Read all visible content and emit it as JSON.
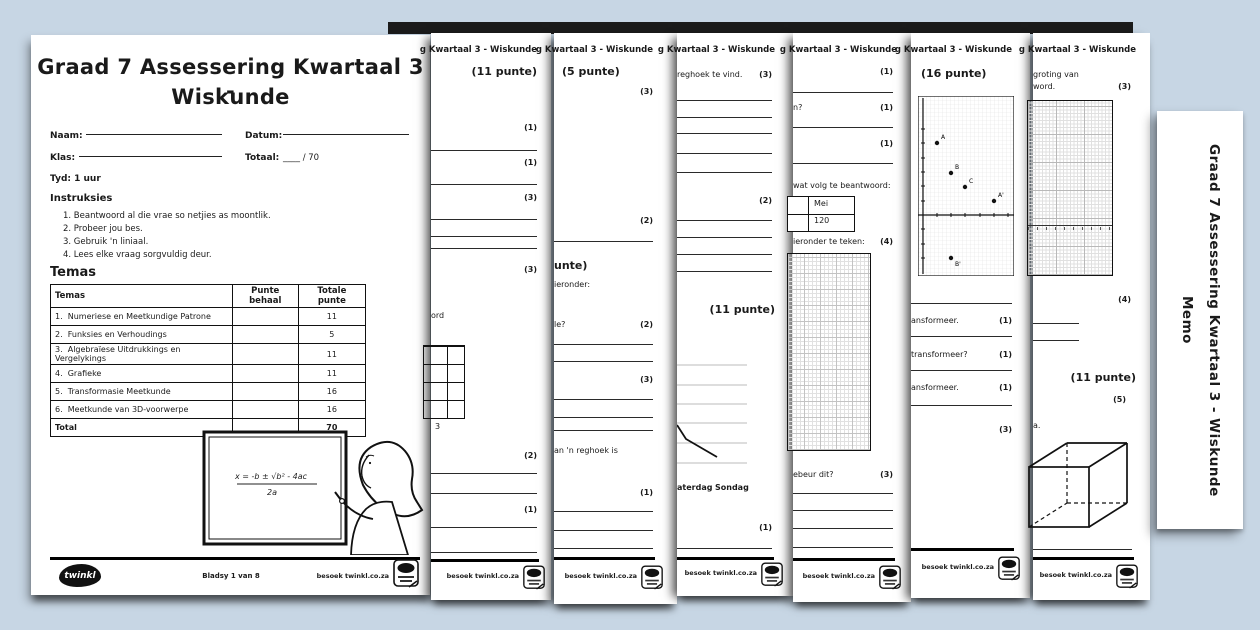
{
  "shared": {
    "strip_header": "g Kwartaal 3 - Wiskunde",
    "visit": "besoek twinkl.co.za",
    "accent_bg": "#c7d6e4",
    "page_color": "#ffffff",
    "ink_color": "#1a1a1a"
  },
  "page1": {
    "title_line1": "Graad 7 Assessering Kwartaal 3 -",
    "title_line2": "Wiskunde",
    "naam_label": "Naam:",
    "datum_label": "Datum:",
    "klas_label": "Klas:",
    "totaal_label": "Totaal:",
    "totaal_value": "____ / 70",
    "tyd": "Tyd: 1 uur",
    "instruksies_heading": "Instruksies",
    "instruksies": [
      "1.  Beantwoord al die vrae so netjies as moontlik.",
      "2.  Probeer jou bes.",
      "3.  Gebruik 'n liniaal.",
      "4.  Lees elke vraag sorgvuldig deur."
    ],
    "temas_heading": "Temas",
    "table": {
      "headers": [
        "Temas",
        "Punte behaal",
        "Totale punte"
      ],
      "rows": [
        {
          "num": "1.",
          "tema": "Numeriese en Meetkundige Patrone",
          "behaal": "",
          "totaal": "11"
        },
        {
          "num": "2.",
          "tema": "Funksies en Verhoudings",
          "behaal": "",
          "totaal": "5"
        },
        {
          "num": "3.",
          "tema": "Algebraïese Uitdrukkings en Vergelykings",
          "behaal": "",
          "totaal": "11"
        },
        {
          "num": "4.",
          "tema": "Grafieke",
          "behaal": "",
          "totaal": "11"
        },
        {
          "num": "5.",
          "tema": "Transformasie Meetkunde",
          "behaal": "",
          "totaal": "16"
        },
        {
          "num": "6.",
          "tema": "Meetkunde van 3D-voorwerpe",
          "behaal": "",
          "totaal": "16"
        }
      ],
      "total_label": "Total",
      "total_value": "70"
    },
    "whiteboard_formula_line1": "x = -b ± √b² - 4ac",
    "whiteboard_formula_line2": "2a",
    "footer": {
      "logo": "twinkl",
      "page": "Bladsy 1 van 8"
    }
  },
  "pages": {
    "p2": {
      "punte": "(11 punte)",
      "marks": [
        "(1)",
        "(1)",
        "(3)",
        "(3)",
        "(2)",
        "(1)"
      ],
      "frag_word": "ord",
      "grid_caption": "3"
    },
    "p3": {
      "punte": "(5 punte)",
      "punte2": "unte)",
      "marks": [
        "(3)",
        "(2)",
        "(2)",
        "(3)",
        "(1)"
      ],
      "frag1": "ieronder:",
      "frag2": "le?",
      "frag3": "an 'n reghoek is"
    },
    "p4": {
      "punte": "(11 punte)",
      "marks": [
        "(3)",
        "(2)",
        "(1)"
      ],
      "frag1": "reghoek te vind.",
      "xlabel1": "aterdag",
      "xlabel2": "Sondag"
    },
    "p5": {
      "marks": [
        "(1)",
        "(1)",
        "(1)",
        "(4)",
        "(3)"
      ],
      "frag1": "n?",
      "frag2": "wat volg te beantwoord:",
      "cell_mei": "Mei",
      "cell_120": "120",
      "frag3": "ieronder te teken:",
      "frag4": "ebeur dit?"
    },
    "p6": {
      "punte": "(16 punte)",
      "marks": [
        "(1)",
        "(1)",
        "(1)",
        "(3)"
      ],
      "frag1": "ansformeer.",
      "frag2": "transformeer?",
      "frag3": "ansformeer.",
      "points": [
        {
          "label": "A",
          "x": 1,
          "y": 5
        },
        {
          "label": "B",
          "x": 2,
          "y": 3
        },
        {
          "label": "C",
          "x": 3,
          "y": 2
        },
        {
          "label": "A'",
          "x": 5,
          "y": 1
        },
        {
          "label": "B'",
          "x": 2,
          "y": -3
        }
      ]
    },
    "p7": {
      "punte": "(11 punte)",
      "marks": [
        "(3)",
        "(4)",
        "(5)"
      ],
      "frag1": "groting van",
      "frag2": "word.",
      "frag3": "a."
    }
  },
  "memo_tab": {
    "line1": "Graad 7 Assessering Kwartaal 3 - Wiskunde",
    "line2": "Memo"
  }
}
